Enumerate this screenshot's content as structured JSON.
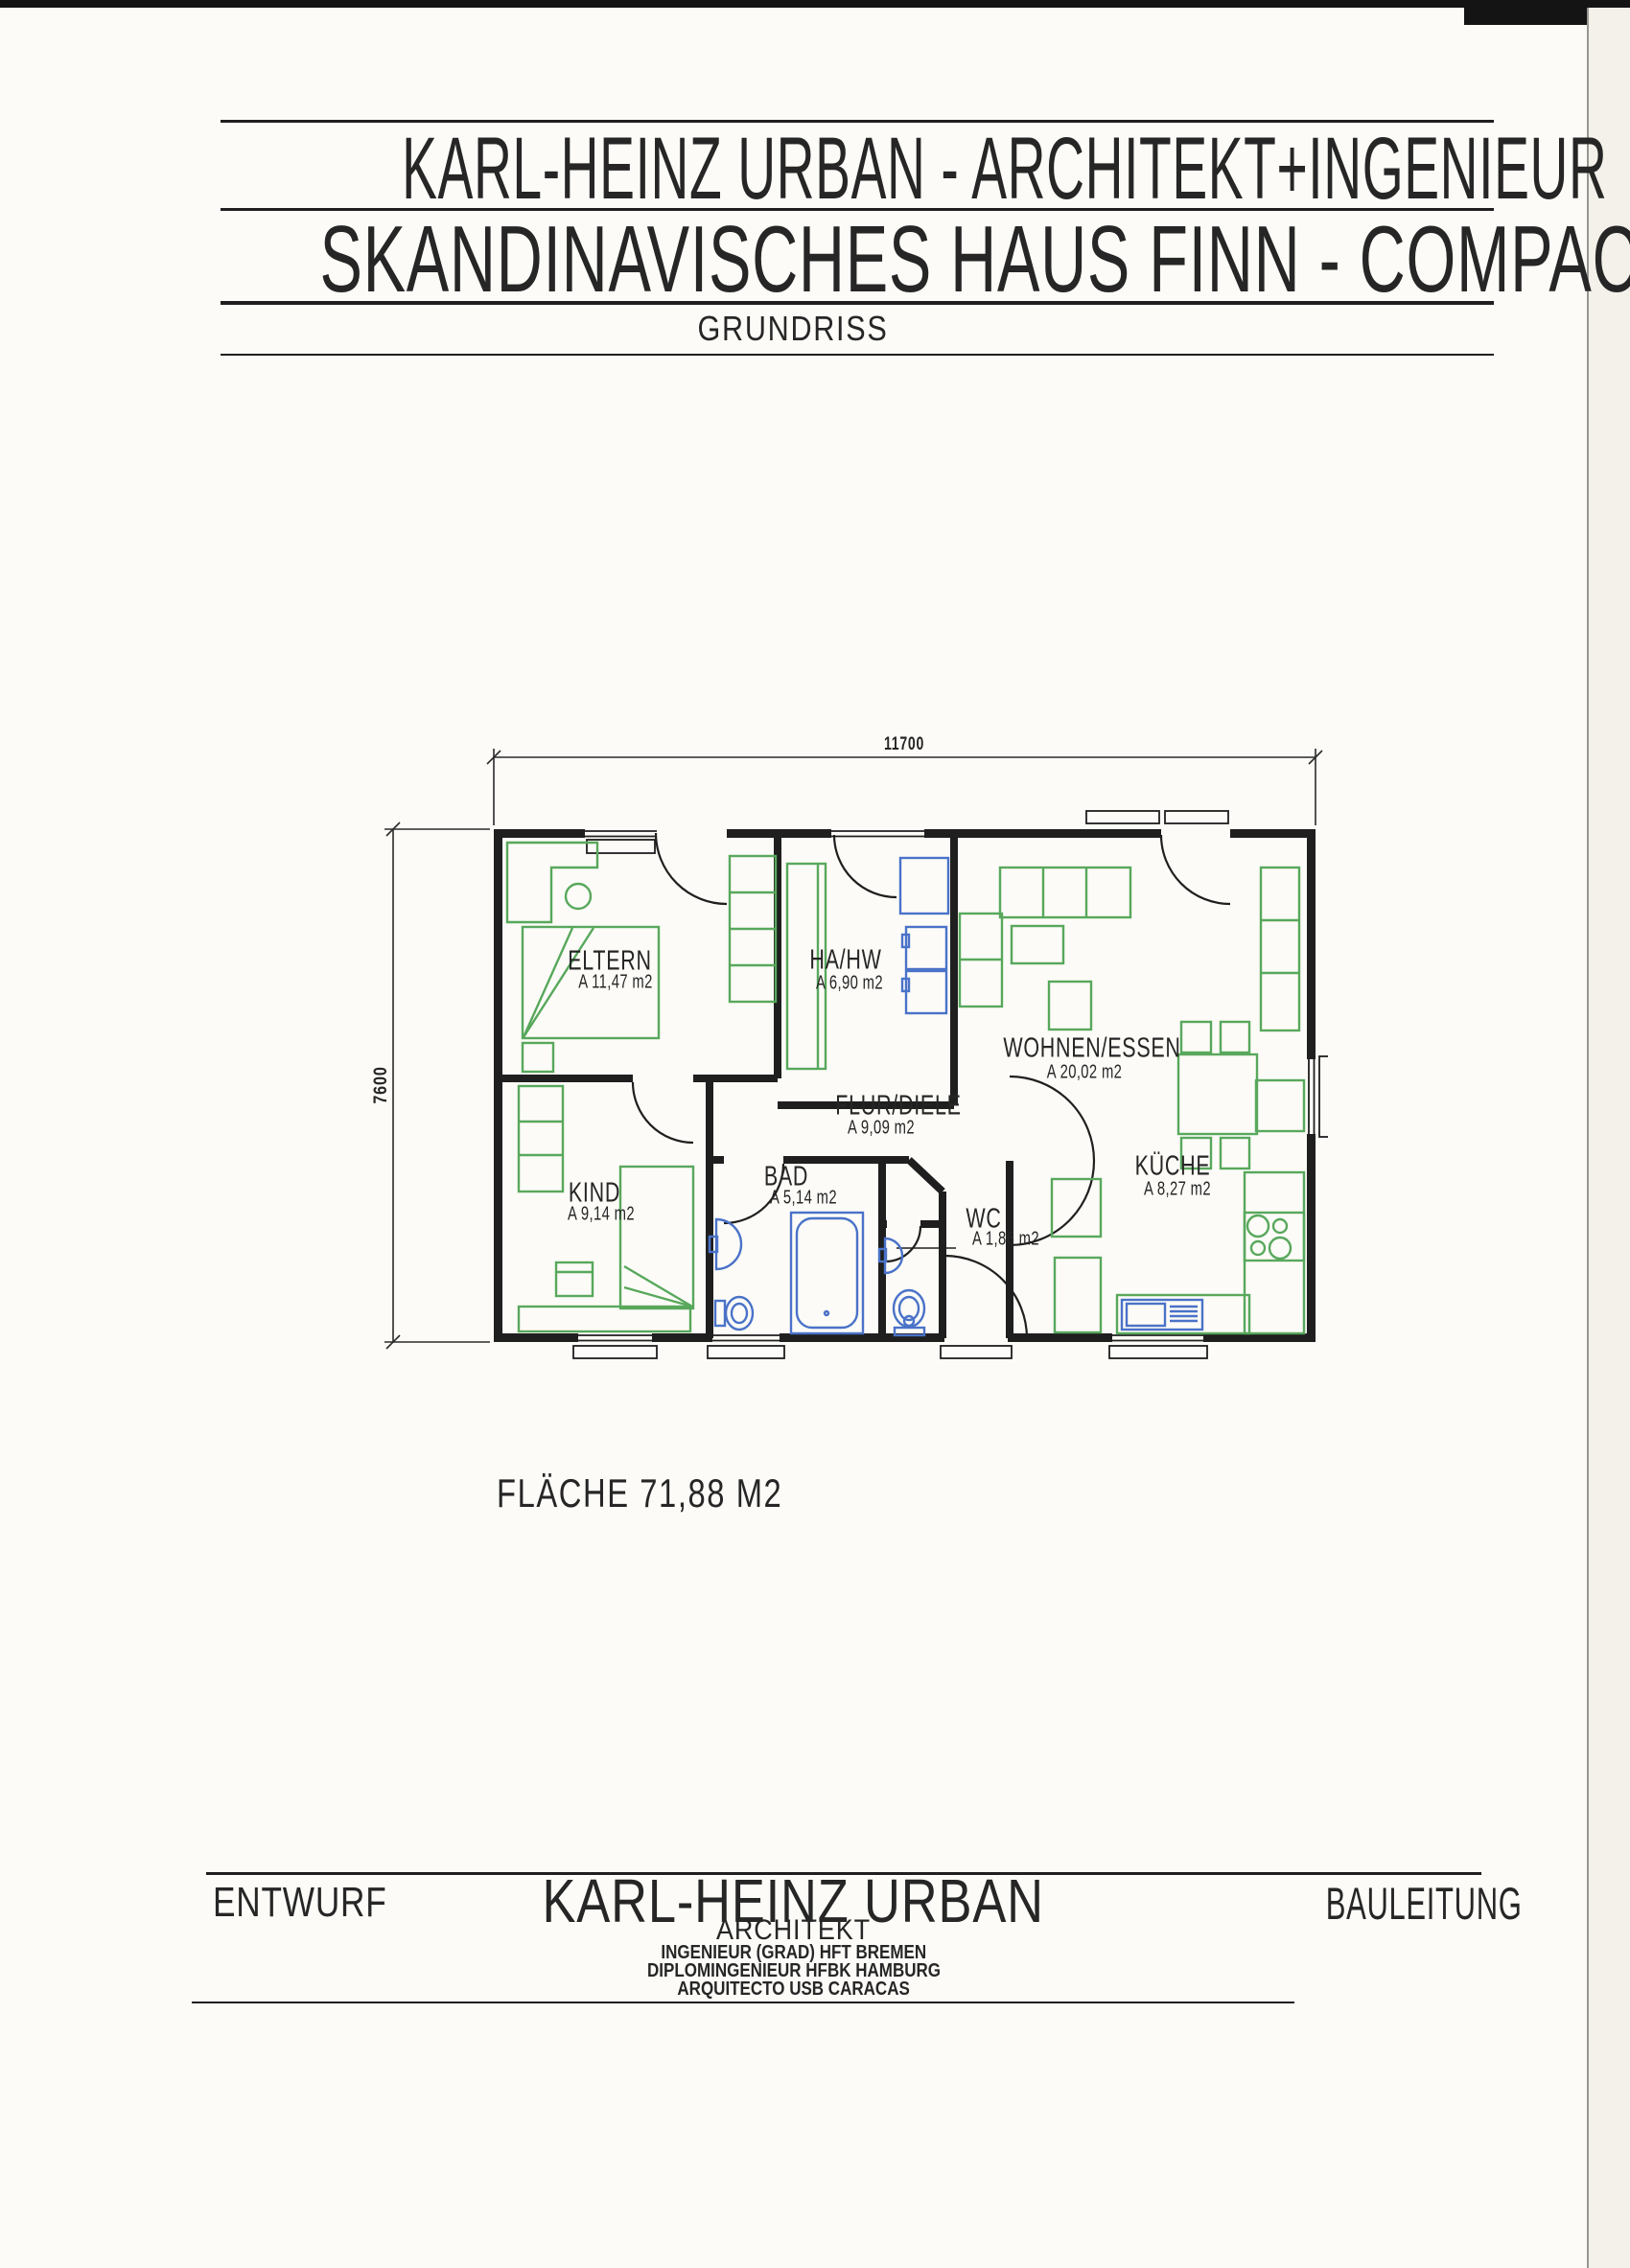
{
  "header": {
    "line1": "KARL-HEINZ URBAN - ARCHITEKT+INGENIEUR",
    "line2": "SKANDINAVISCHES HAUS FINN - COMPACT",
    "line3": "GRUNDRISS"
  },
  "plan": {
    "dim_width": "11700",
    "dim_height": "7600",
    "rooms": [
      {
        "name": "ELTERN",
        "area": "A 11,47 m2"
      },
      {
        "name": "HA/HW",
        "area": "A 6,90 m2"
      },
      {
        "name": "WOHNEN/ESSEN",
        "area": "A 20,02 m2"
      },
      {
        "name": "FLUR/DIELE",
        "area": "A 9,09 m2"
      },
      {
        "name": "KIND",
        "area": "A 9,14 m2"
      },
      {
        "name": "BAD",
        "area": "A 5,14 m2"
      },
      {
        "name": "WC",
        "area": "A 1,86 m2"
      },
      {
        "name": "KÜCHE",
        "area": "A 8,27 m2"
      }
    ],
    "total_area": "FLÄCHE 71,88 M2"
  },
  "footer": {
    "left": "ENTWURF",
    "architect": "KARL-HEINZ URBAN",
    "architect_title": "ARCHITEKT",
    "credentials": [
      "INGENIEUR (GRAD) HFT BREMEN",
      "DIPLOMINGENIEUR HFBK HAMBURG",
      "ARQUITECTO USB CARACAS"
    ],
    "right": "BAULEITUNG"
  },
  "colors": {
    "ink": "#1f1f1f",
    "furniture_green": "#58a85c",
    "fixture_blue": "#4a72c8",
    "paper": "#fcfbf7"
  }
}
